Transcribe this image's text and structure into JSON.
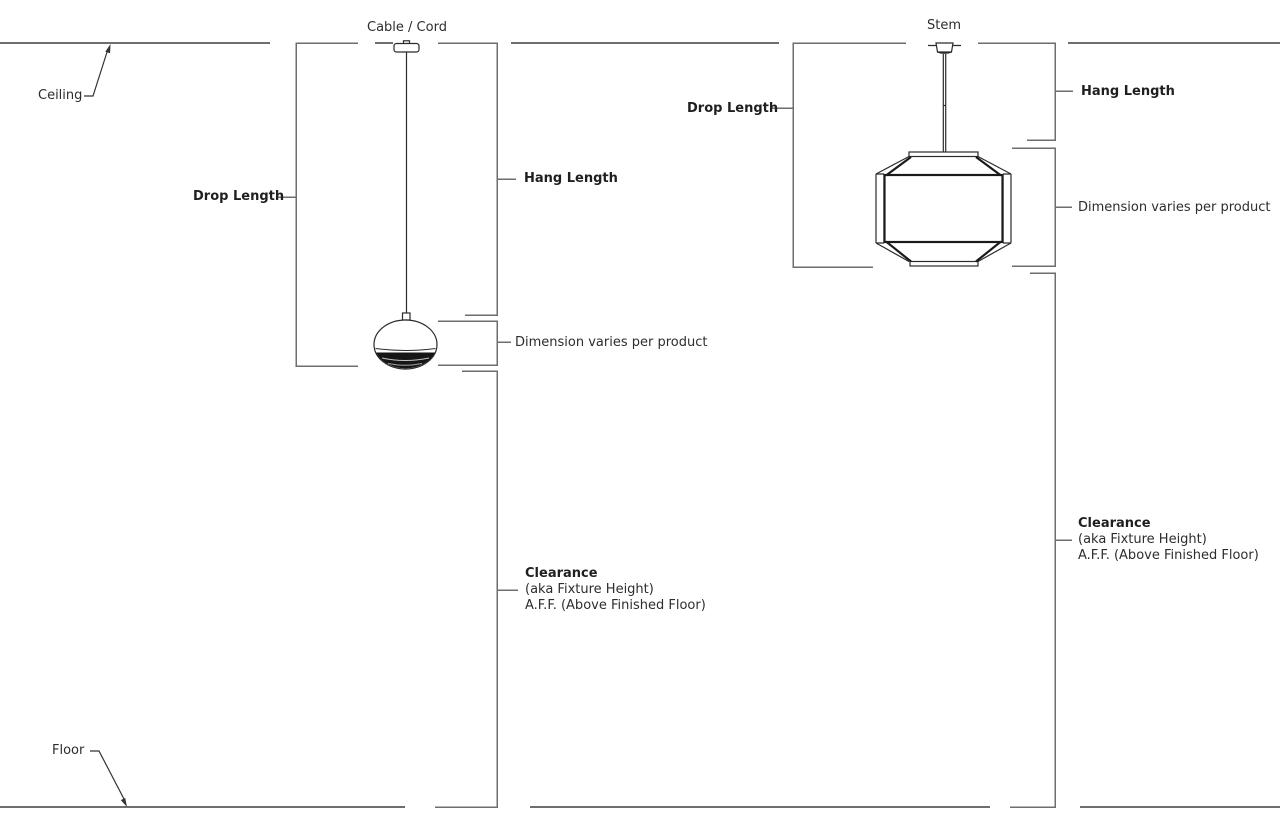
{
  "diagram_title": "Pendant lighting measurement terminology diagram",
  "colors": {
    "background": "#ffffff",
    "room_line": "#6e6e6e",
    "bracket_line": "#6e6e6e",
    "fixture_line": "#2b2b2b",
    "fixture_bold_line": "#1a1a1a",
    "annotation_line": "#333333",
    "text": "#2d2d2d"
  },
  "room": {
    "ceiling_label": "Ceiling",
    "floor_label": "Floor"
  },
  "left_figure": {
    "fixture_type": "globe pendant",
    "suspension_label": "Cable / Cord",
    "drop_length_label": "Drop Length",
    "hang_length_label": "Hang Length",
    "dimension_label": "Dimension varies per product",
    "clearance_label": "Clearance",
    "clearance_sub1": "(aka Fixture Height)",
    "clearance_sub2": "A.F.F. (Above Finished Floor)"
  },
  "right_figure": {
    "fixture_type": "lantern pendant",
    "suspension_label": "Stem",
    "drop_length_label": "Drop Length",
    "hang_length_label": "Hang Length",
    "dimension_label": "Dimension varies per product",
    "clearance_label": "Clearance",
    "clearance_sub1": "(aka Fixture Height)",
    "clearance_sub2": "A.F.F. (Above Finished Floor)"
  }
}
